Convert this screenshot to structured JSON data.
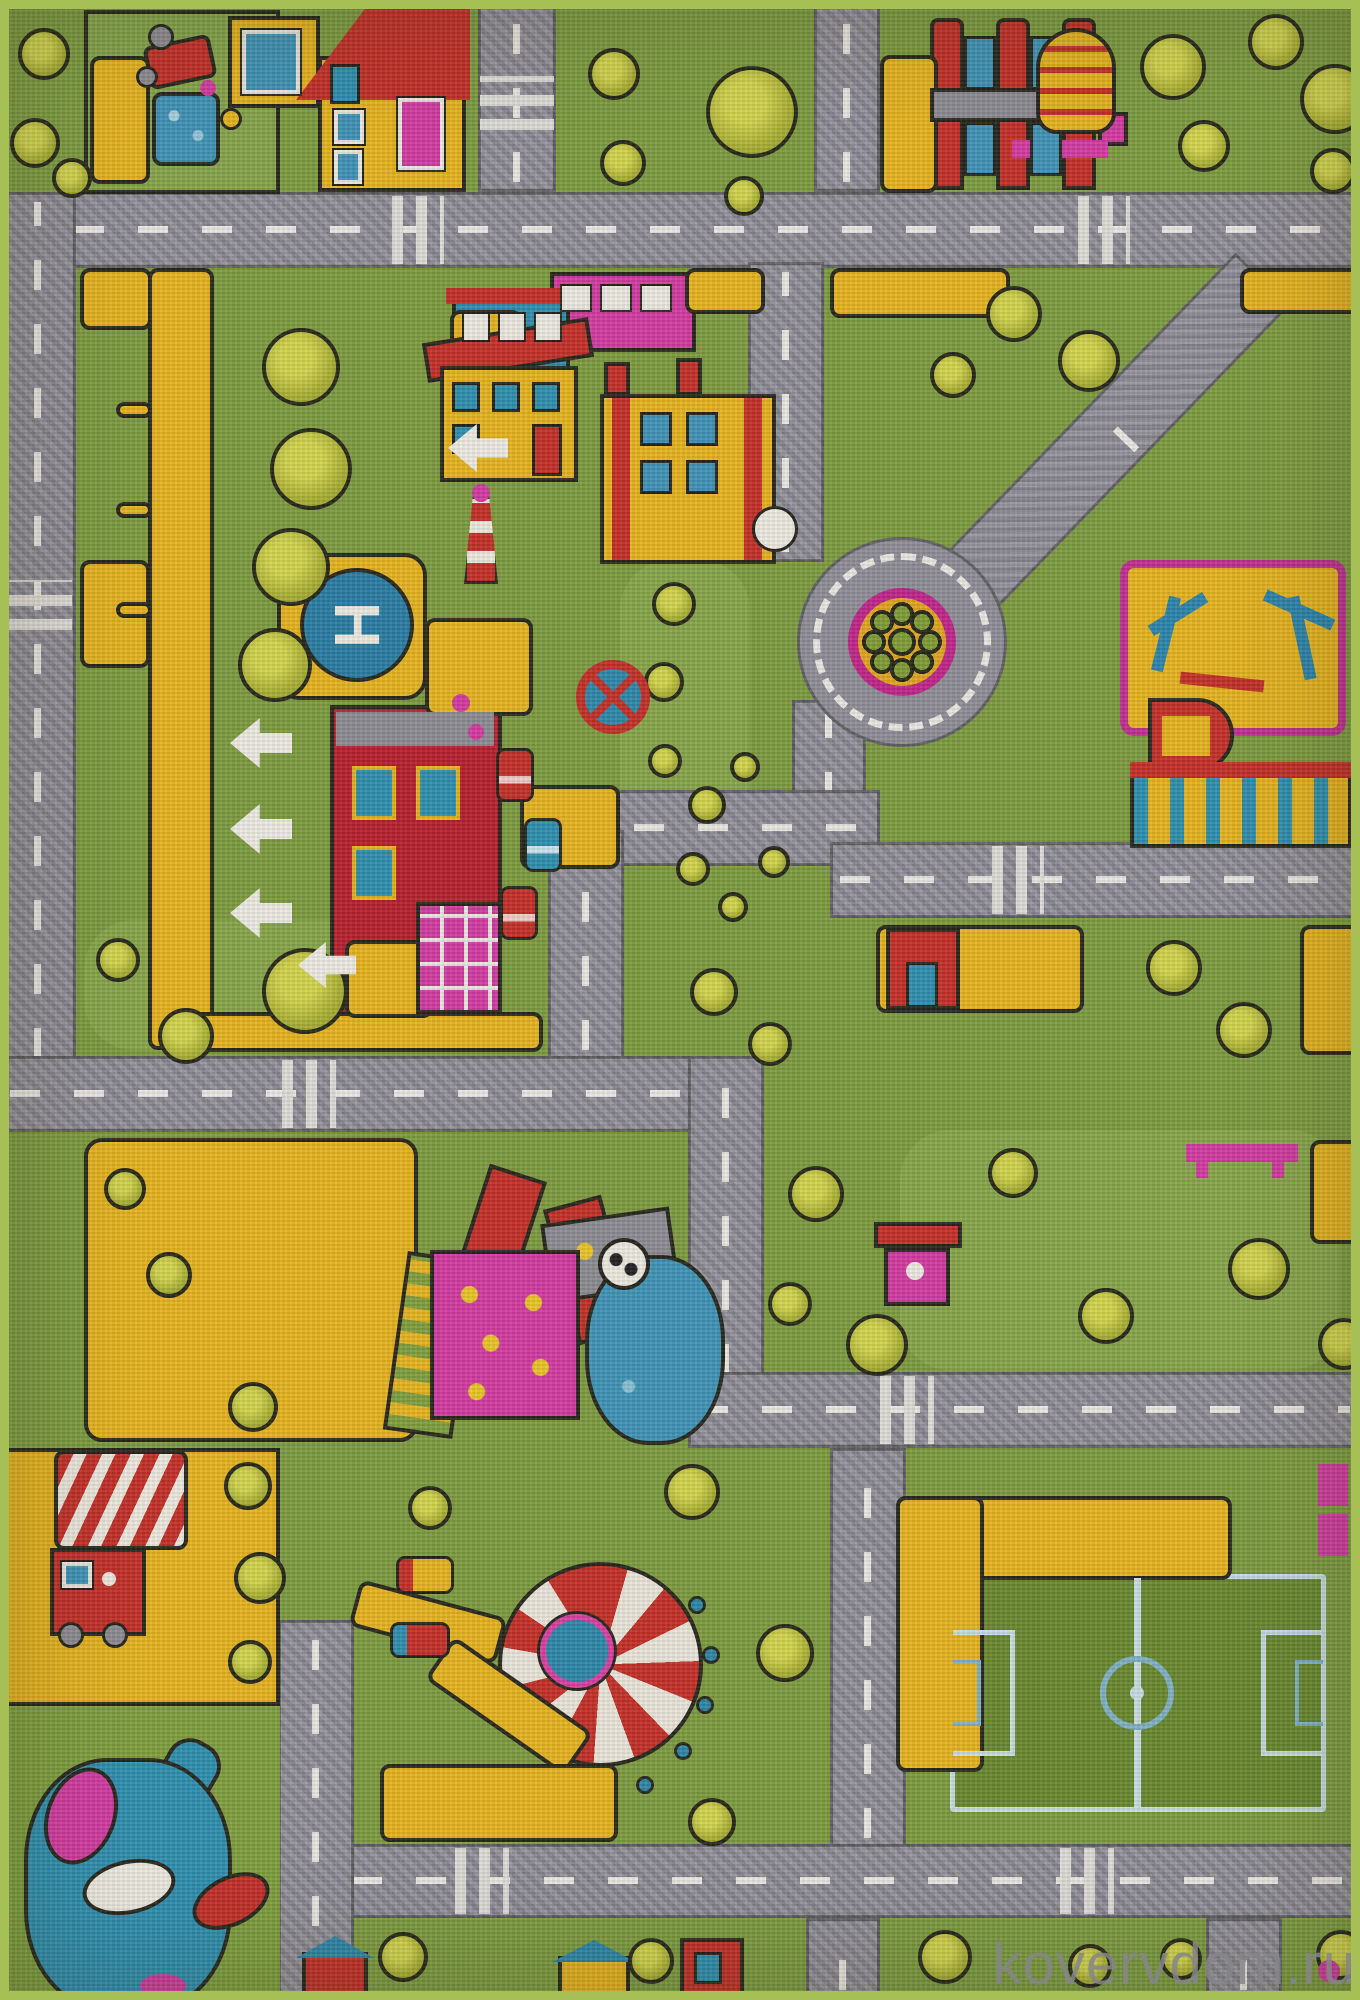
{
  "watermark": {
    "text": "kovervdom.ru"
  },
  "helipad": {
    "letter": "H"
  },
  "palette": {
    "grass_green": "#7d9b40",
    "road_gray": "#8f8d96",
    "lane_white": "#e9e7e1",
    "sand_yellow": "#e5b31f",
    "brick_red": "#c23028",
    "magenta_pink": "#d13ba0",
    "teal_blue": "#2f8fae",
    "water_blue": "#3f93b5",
    "foliage_green": "#b0b536",
    "rug_edge_green": "#a6c055"
  }
}
